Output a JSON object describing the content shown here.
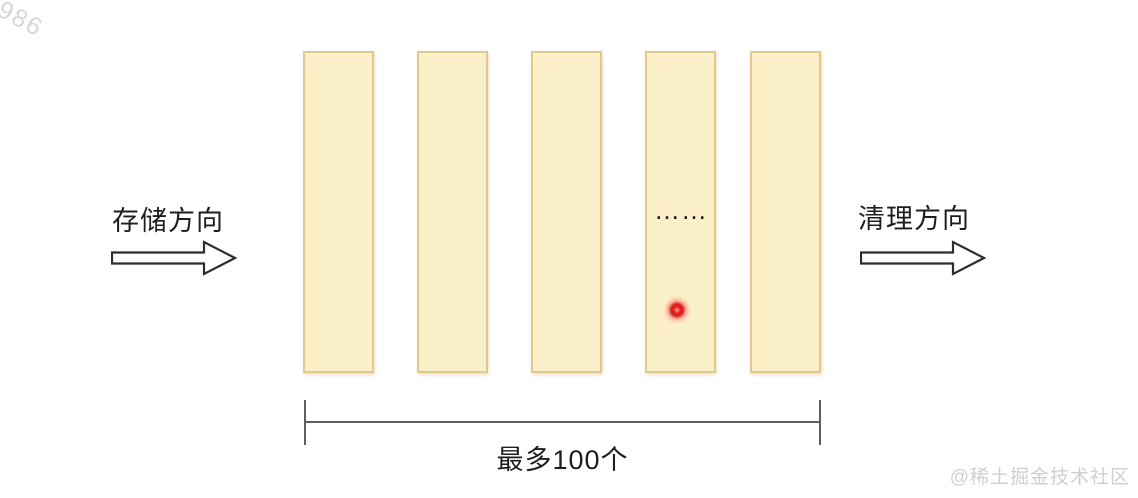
{
  "watermarks": {
    "corner_number": "3986",
    "community_credit": "@稀土掘金技术社区"
  },
  "diagram": {
    "storage_direction_label": "存储方向",
    "cleanup_direction_label": "清理方向",
    "ellipsis": "……",
    "capacity_label": "最多100个",
    "slot_count": 5,
    "colors": {
      "slot_fill": "#fcf0c9",
      "slot_border": "#e0c88f",
      "text": "#1e1e1e",
      "arrow_stroke": "#2d2d2d",
      "bracket": "#5f5f5f",
      "laser_dot": "#d81f1f",
      "watermark_gray": "#cfcfcf"
    }
  }
}
